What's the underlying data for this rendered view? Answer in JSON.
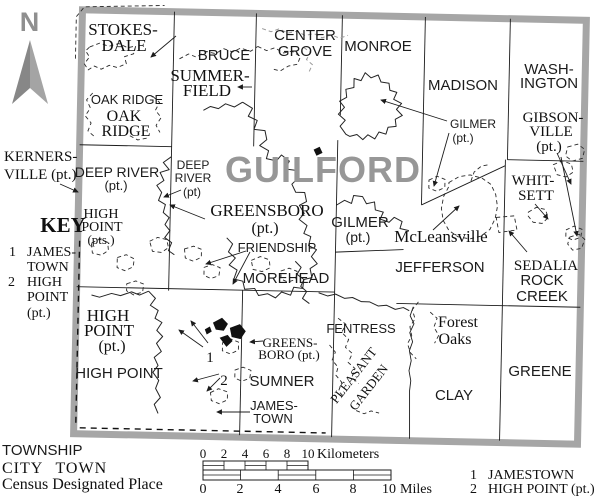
{
  "county": {
    "name": "GUILFORD"
  },
  "compass": {
    "north": "N"
  },
  "key": {
    "title": "KEY",
    "item1_num": "1",
    "item1_line1": "JAMES-",
    "item1_line2": "TOWN",
    "item2_num": "2",
    "item2_line1": "HIGH",
    "item2_line2": "POINT",
    "item2_line3": "(pt.)"
  },
  "townships": {
    "bruce": "BRUCE",
    "center_grove_1": "CENTER",
    "center_grove_2": "GROVE",
    "monroe": "MONROE",
    "madison": "MADISON",
    "washington_1": "WASH-",
    "washington_2": "INGTON",
    "oak_ridge": "OAK RIDGE",
    "deep_river_1": "DEEP RIVER",
    "deep_river_2": "(pt.)",
    "deep_river_sm_1": "DEEP",
    "deep_river_sm_2": "RIVER",
    "deep_river_sm_3": "(pt)",
    "gilmer_1": "GILMER",
    "gilmer_2": "(pt.)",
    "gilmer_ne_1": "GILMER",
    "gilmer_ne_2": "(pt.)",
    "friendship": "FRIENDSHIP",
    "morehead": "MOREHEAD",
    "jefferson": "JEFFERSON",
    "rock_creek_1": "ROCK",
    "rock_creek_2": "CREEK",
    "fentress": "FENTRESS",
    "clay": "CLAY",
    "greene": "GREENE",
    "sumner": "SUMNER",
    "jamestown_1": "JAMES-",
    "jamestown_2": "TOWN",
    "high_point": "HIGH POINT"
  },
  "places": {
    "stokesdale_1": "STOKES-",
    "stokesdale_2": "DALE",
    "summerfield_1": "SUMMER-",
    "summerfield_2": "FIELD",
    "oak_ridge_1": "OAK",
    "oak_ridge_2": "RIDGE",
    "kernersville_1": "KERNERS-",
    "kernersville_2": "VILLE (pt.)",
    "high_point_pts_1": "HIGH",
    "high_point_pts_2": "POINT",
    "high_point_pts_3": "(pts.)",
    "greensboro_1": "GREENSBORO",
    "greensboro_2": "(pt.)",
    "greensboro_sm_1": "GREENS-",
    "greensboro_sm_2": "BORO (pt.)",
    "high_point_city_1": "HIGH",
    "high_point_city_2": "POINT",
    "high_point_city_3": "(pt.)",
    "whitsett_1": "WHIT-",
    "whitsett_2": "SETT",
    "gibsonville_1": "GIBSON-",
    "gibsonville_2": "VILLE",
    "gibsonville_3": "(pt.)",
    "sedalia": "SEDALIA",
    "pleasant_garden_1": "PLEASANT",
    "pleasant_garden_2": "GARDEN",
    "ref1": "1",
    "ref2": "2"
  },
  "cdps": {
    "mcleansville": "McLeansville",
    "forest_oaks_1": "Forest",
    "forest_oaks_2": "Oaks"
  },
  "legend": {
    "township": "TOWNSHIP",
    "city_town": "CITY TOWN",
    "cdp": "Census Designated Place",
    "ref1_num": "1",
    "ref1_name": "JAMESTOWN",
    "ref2_num": "2",
    "ref2_name": "HIGH POINT (pt.)"
  },
  "scale": {
    "km_ticks": [
      "0",
      "2",
      "4",
      "6",
      "8",
      "10"
    ],
    "km_unit": "Kilometers",
    "mi_ticks": [
      "0",
      "2",
      "4",
      "6",
      "8",
      "10"
    ],
    "mi_unit": "Miles"
  },
  "colors": {
    "county_border": "#a6a6a6",
    "county_name": "#979797",
    "compass": "#8f8f8f",
    "ink": "#1c1c1c"
  }
}
